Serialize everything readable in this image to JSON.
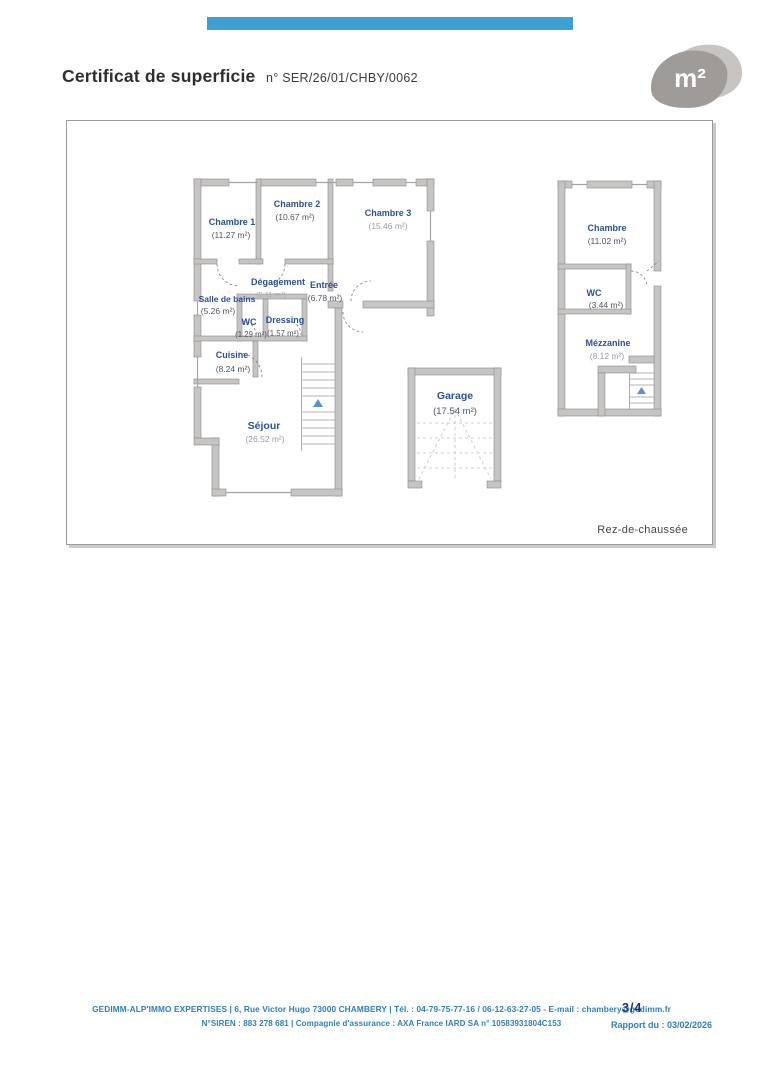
{
  "header": {
    "title": "Certificat de superficie",
    "reference": "n° SER/26/01/CHBY/0062",
    "logo_text": "m²",
    "accent_bar_color": "#3da0d2"
  },
  "plan": {
    "floor_label": "Rez-de-chaussée",
    "label_color": "#2b4fa0",
    "rooms": {
      "ch1": {
        "name": "Chambre 1",
        "area": "(11.27 m²)"
      },
      "ch2": {
        "name": "Chambre 2",
        "area": "(10.67 m²)"
      },
      "ch3": {
        "name": "Chambre 3",
        "area": "(15.46 m²)"
      },
      "degagement": {
        "name": "Dégagement",
        "area": "(5.11 m²)"
      },
      "entree": {
        "name": "Entrée",
        "area": "(6.78 m²)"
      },
      "sdb": {
        "name": "Salle de bains",
        "area": "(5.26 m²)"
      },
      "wc1": {
        "name": "WC",
        "area": "(1.29 m²)"
      },
      "dressing": {
        "name": "Dressing",
        "area": "(1.57 m²)"
      },
      "cuisine": {
        "name": "Cuisine",
        "area": "(8.24 m²)"
      },
      "sejour": {
        "name": "Séjour",
        "area": "(26.52 m²)"
      },
      "garage": {
        "name": "Garage",
        "area": "(17.54 m²)"
      },
      "ch_r": {
        "name": "Chambre",
        "area": "(11.02 m²)"
      },
      "wc2": {
        "name": "WC",
        "area": "(3.44 m²)"
      },
      "mezzanine": {
        "name": "Mézzanine",
        "area": "(8.12 m²)"
      }
    }
  },
  "footer": {
    "line1": "GEDIMM-ALP'IMMO EXPERTISES | 6, Rue Victor Hugo 73000 CHAMBERY | Tél. : 04-79-75-77-16  /  06-12-63-27-05 - E-mail : chambery@gedimm.fr",
    "line2": "N°SIREN : 883 278 681 | Compagnie d'assurance : AXA France IARD SA n° 10583931804C153",
    "report_date": "Rapport du : 03/02/2026",
    "page_number": "3/4",
    "text_color": "#2d7fc0"
  }
}
